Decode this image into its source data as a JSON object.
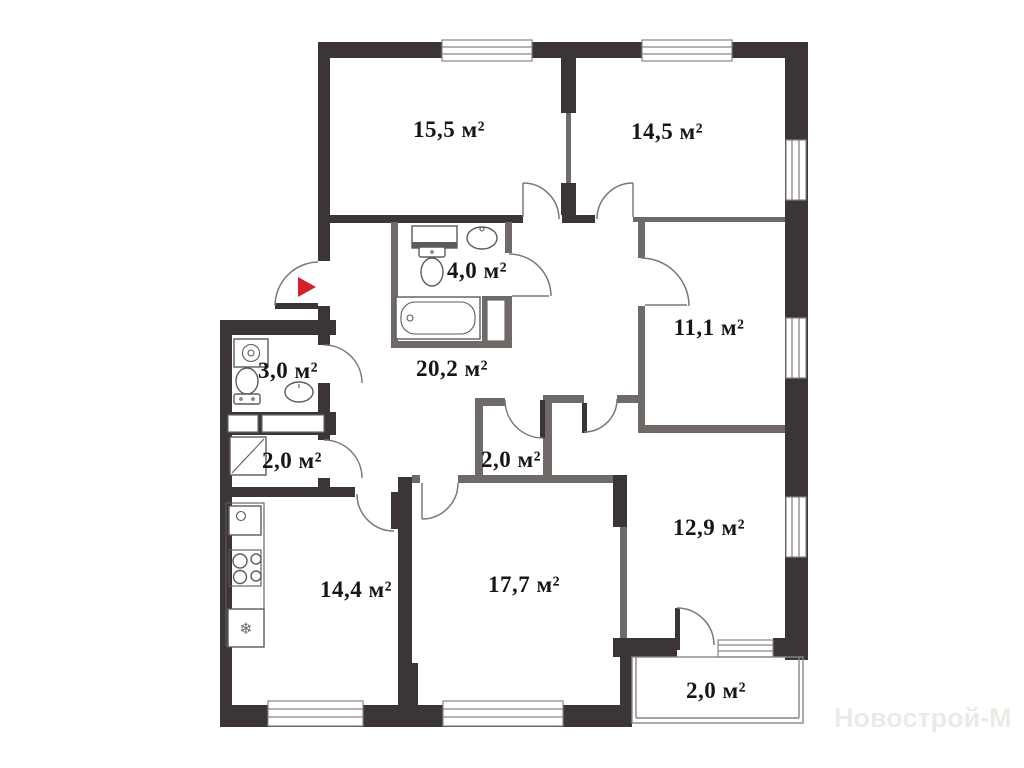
{
  "watermark": "Новострой-М",
  "units": "м²",
  "icons": {
    "entrance_arrow": "▶",
    "snowflake": "❄"
  },
  "rooms": [
    {
      "name": "room-15-5",
      "area_label": "15,5 м²"
    },
    {
      "name": "room-14-5",
      "area_label": "14,5 м²"
    },
    {
      "name": "bathroom",
      "area_label": "4,0 м²"
    },
    {
      "name": "room-11-1",
      "area_label": "11,1 м²"
    },
    {
      "name": "wc",
      "area_label": "3,0 м²"
    },
    {
      "name": "hallway",
      "area_label": "20,2 м²"
    },
    {
      "name": "storage",
      "area_label": "2,0 м²"
    },
    {
      "name": "wardrobe",
      "area_label": "2,0 м²"
    },
    {
      "name": "room-12-9",
      "area_label": "12,9 м²"
    },
    {
      "name": "kitchen",
      "area_label": "14,4 м²"
    },
    {
      "name": "room-17-7",
      "area_label": "17,7 м²"
    },
    {
      "name": "balcony",
      "area_label": "2,0 м²"
    }
  ],
  "colors": {
    "wall": "#3b3438",
    "partition": "#6f6a67",
    "entrance_arrow": "#d4222d",
    "watermark": "#edeae6"
  }
}
